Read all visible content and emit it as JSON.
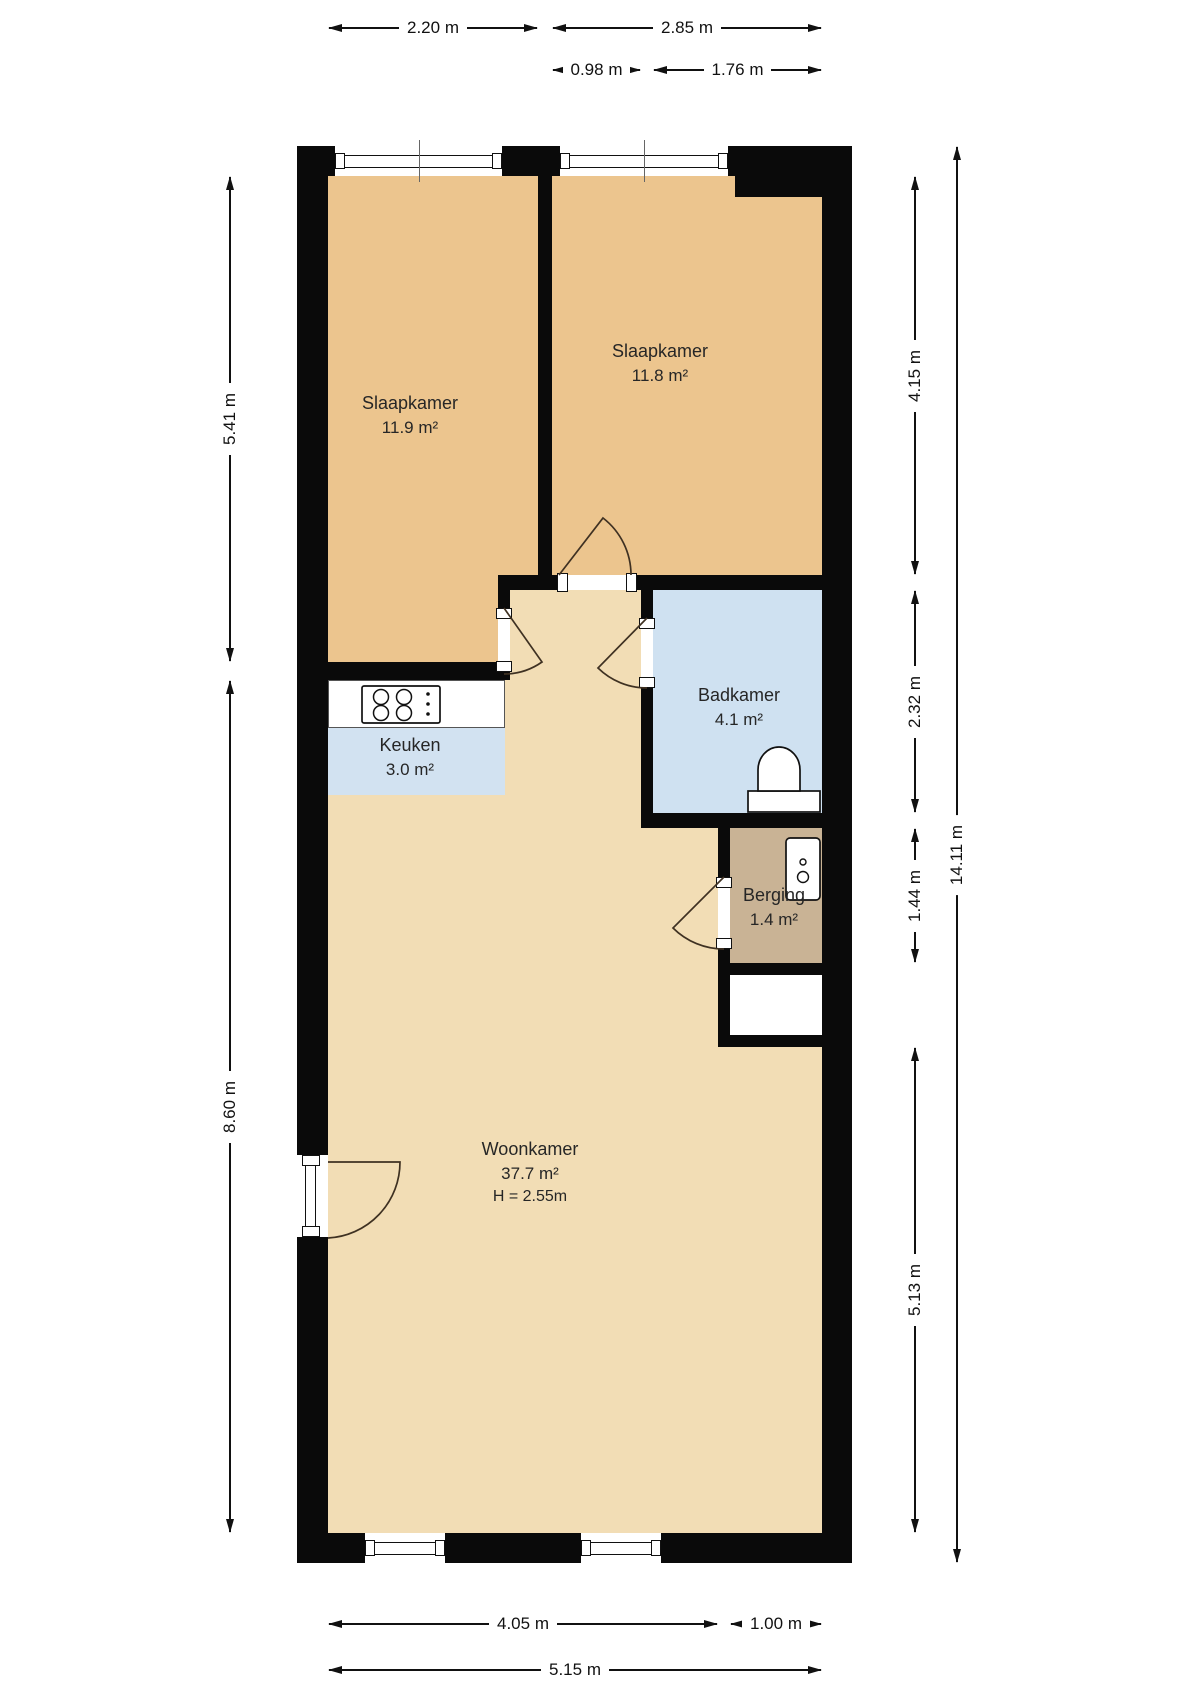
{
  "plan": {
    "rooms": [
      {
        "name": "Slaapkamer",
        "area": "11.9 m²"
      },
      {
        "name": "Slaapkamer",
        "area": "11.8 m²"
      },
      {
        "name": "Badkamer",
        "area": "4.1 m²"
      },
      {
        "name": "Keuken",
        "area": "3.0 m²"
      },
      {
        "name": "Berging",
        "area": "1.4 m²"
      },
      {
        "name": "Woonkamer",
        "area": "37.7 m²",
        "ceiling": "H = 2.55m"
      }
    ],
    "dims": {
      "top1": [
        "2.20 m",
        "2.85 m"
      ],
      "top2": [
        "0.98 m",
        "1.76 m"
      ],
      "left": [
        "5.41 m",
        "8.60 m"
      ],
      "right_inner": [
        "4.15 m",
        "2.32 m",
        "1.44 m",
        "5.13 m"
      ],
      "right_outer": "14.11 m",
      "bottom1": [
        "4.05 m",
        "1.00 m"
      ],
      "bottom2": "5.15 m"
    },
    "icons": [
      "window",
      "door-swing",
      "stove",
      "toilet",
      "boiler"
    ],
    "colors": {
      "wall": "#0a0a0a",
      "bedroom_tan": "#ecc58e",
      "floor_light": "#f2ddb5",
      "bath_blue": "#cfe1f1",
      "storage_brown": "#c9b395",
      "text": "#1c1c1c"
    }
  }
}
